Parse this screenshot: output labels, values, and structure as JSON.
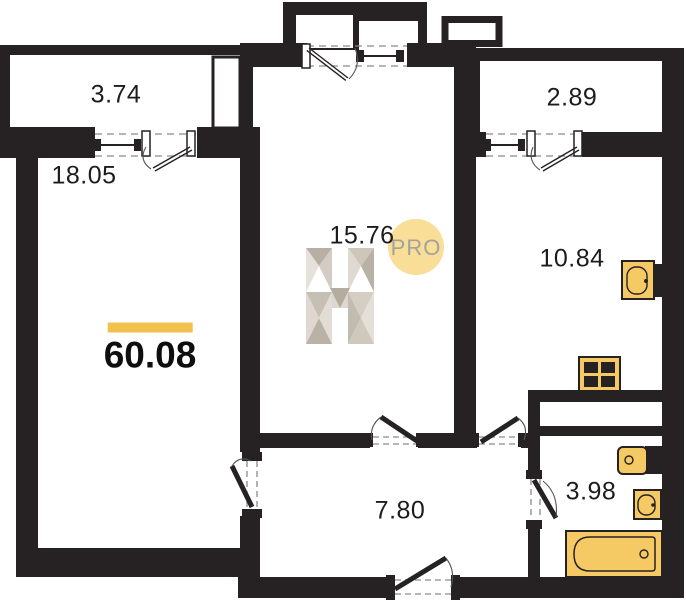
{
  "plan": {
    "title": "apartment-floor-plan",
    "total_area": {
      "value": "60.08"
    },
    "rooms": {
      "balcony_left": {
        "area": "3.74"
      },
      "bedroom": {
        "area": "18.05"
      },
      "living": {
        "area": "15.76"
      },
      "balcony_right": {
        "area": "2.89"
      },
      "kitchen": {
        "area": "10.84"
      },
      "corridor": {
        "area": "7.80"
      },
      "bathroom": {
        "area": "3.98"
      }
    },
    "watermark": {
      "letter": "H",
      "pro_label": "PRO"
    },
    "fixtures": [
      "kitchen-sink-icon",
      "stove-icon",
      "toilet-icon",
      "bathroom-sink-icon",
      "bathtub-icon"
    ],
    "colors": {
      "wall": "#262122",
      "accent_yellow": "#F2C14E",
      "fixture_fill": "#F5C963",
      "watermark_circle": "#F8DE96",
      "watermark_text": "#A5A29C"
    }
  }
}
